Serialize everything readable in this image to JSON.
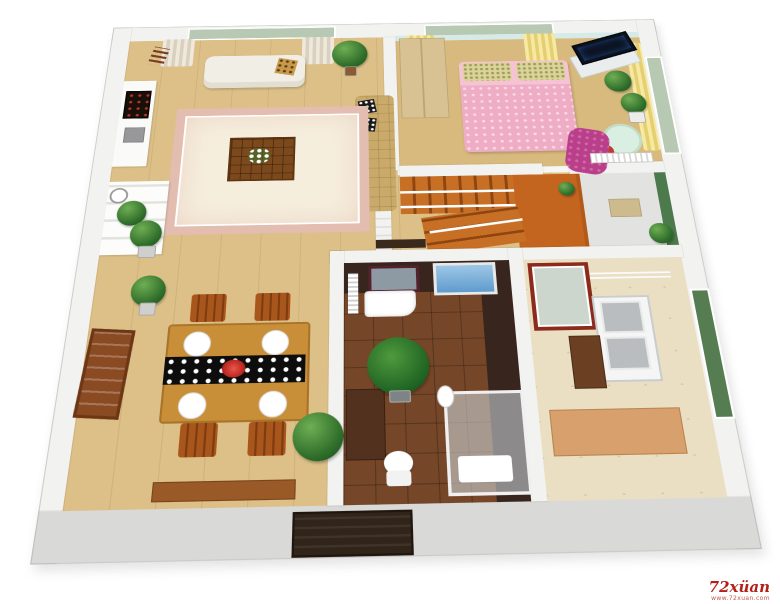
{
  "watermark": {
    "brand": "72xüan",
    "site": "www.72xuan.com"
  },
  "palette": {
    "wall": "#f2f2f0",
    "front_wall": "#d9d9d7",
    "wood_floor": "#dcc088",
    "stair_wood": "#c4651f",
    "rug": "#f6eedd",
    "rug_border": "#e2bdb0",
    "bed_pink": "#f5c3d3",
    "curtain_yellow": "#f0dd8e",
    "curtain_beige": "#e7dfd0",
    "bath_tile_dark": "#38261e",
    "bath_floor": "#754728",
    "kitchen_floor": "#ecdfc0",
    "shower_glass": "#7fb3dd",
    "plant_green": "#2e6d2a",
    "accent_red": "#d2342b",
    "chaise_magenta": "#ba3f8a",
    "mint_table": "#d9efe2",
    "entry_door": "#31251a",
    "window_glass": "#b7c9b2",
    "balcony_wall_green": "#4d7a4d",
    "watermark_red": "#b22018"
  },
  "rooms": {
    "living_room": {
      "items": [
        "window",
        "beige-curtains",
        "white-loveseat",
        "leopard-pillow",
        "gold-sofa",
        "throw-pillows",
        "area-rug",
        "carved-coffee-table",
        "flower-centerpiece",
        "potted-plant",
        "tv-cabinet",
        "wall-art",
        "wall-shelf",
        "shelf-plants",
        "wall-clock",
        "slat-decor"
      ]
    },
    "bedroom": {
      "items": [
        "window",
        "yellow-curtains",
        "wardrobe",
        "double-bed",
        "floral-pillows",
        "tv",
        "tv-stand",
        "potted-plants",
        "mint-round-table",
        "red-stool",
        "magenta-chaise",
        "radiator",
        "aqua-wallpaper"
      ]
    },
    "staircase": {
      "items": [
        "upper-flight",
        "landing",
        "lower-flight",
        "white-railing",
        "half-wall",
        "potted-plant",
        "dark-bench"
      ]
    },
    "balcony": {
      "items": [
        "door-mat",
        "potted-plant",
        "green-accent-wall"
      ]
    },
    "dining_room": {
      "items": [
        "wood-table",
        "black-white-runner",
        "red-flower",
        "four-plates",
        "four-chairs",
        "low-bench",
        "sideboard-art",
        "potted-plants"
      ]
    },
    "bathroom": {
      "items": [
        "maroon-mirror",
        "vanity-sink",
        "towel-radiator",
        "blue-shower-door",
        "fern-plant",
        "dark-cabinet",
        "toilet",
        "glass-shower-enclosure",
        "dark-tile-walls"
      ]
    },
    "kitchen": {
      "items": [
        "red-framed-door",
        "drying-rack",
        "double-sink",
        "brown-cabinet",
        "counter",
        "green-glass-door",
        "marble-tile-floor"
      ]
    }
  }
}
